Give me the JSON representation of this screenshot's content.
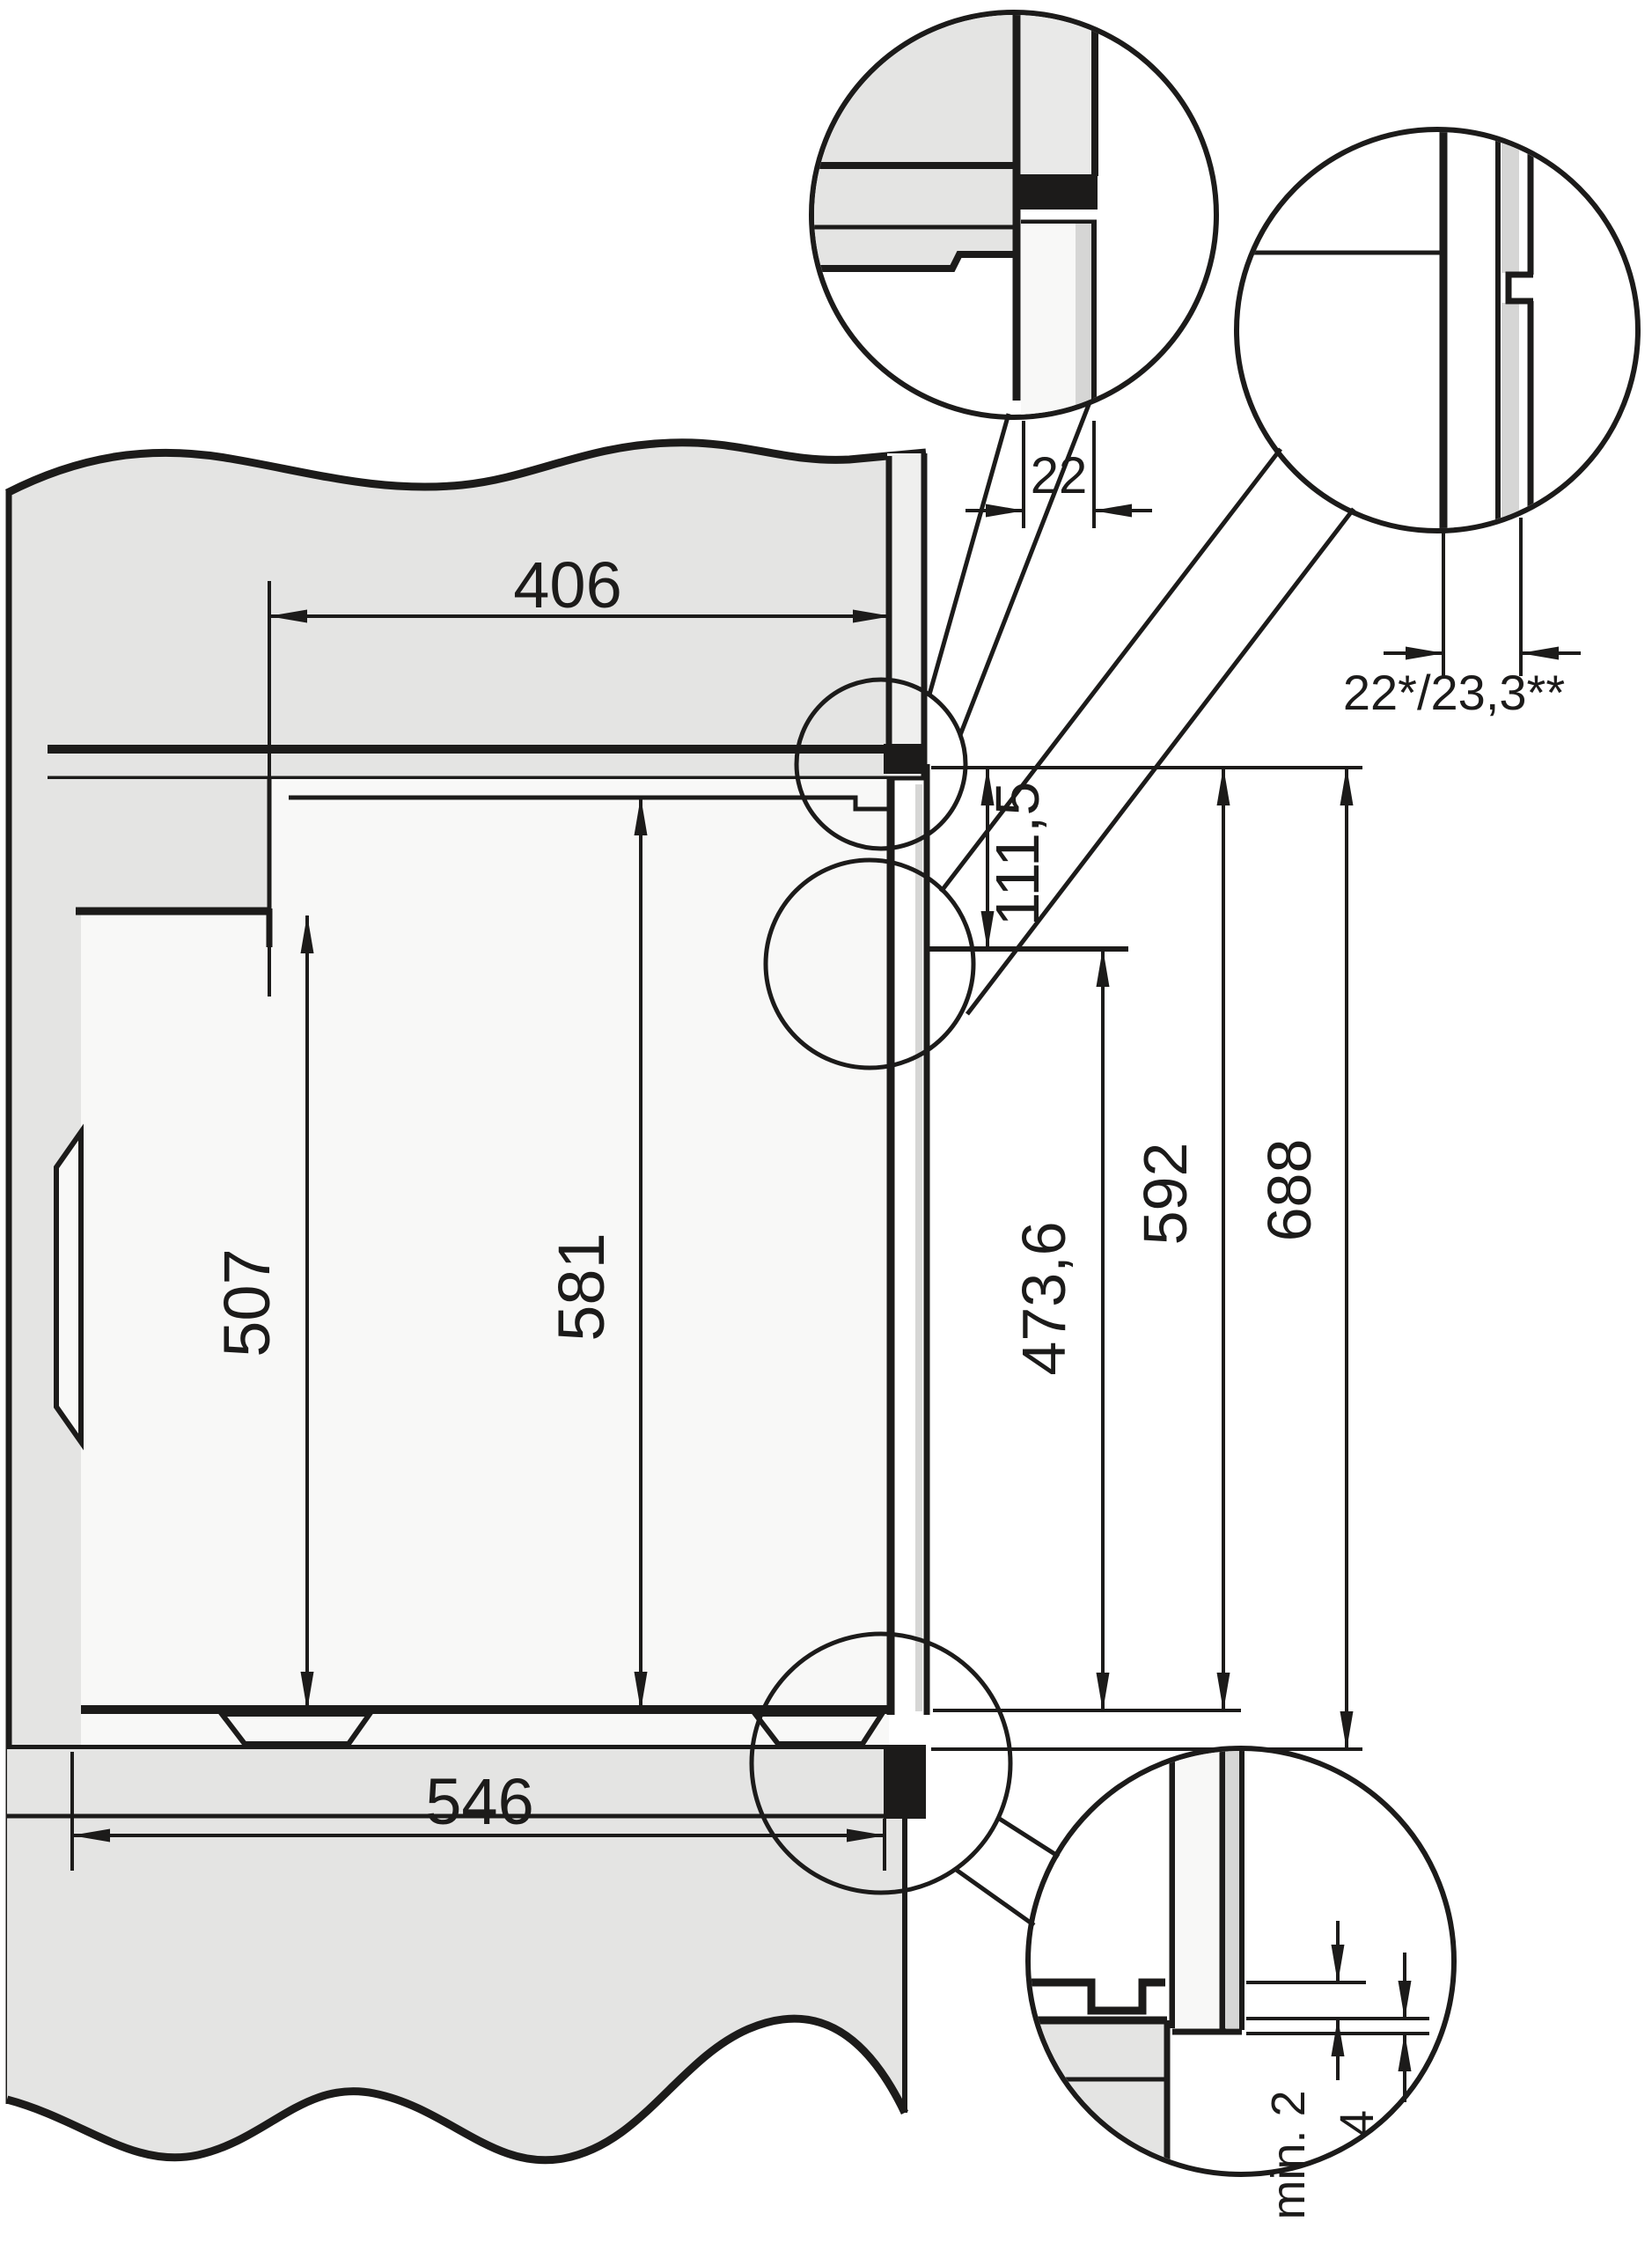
{
  "colors": {
    "ink": "#1c1b1a",
    "cabinet_fill": "#e4e4e3",
    "front_board_fill": "#efefee",
    "door_edge_fill": "#d6d6d5",
    "interior_fill": "#f8f8f7",
    "background": "#ffffff"
  },
  "dimensions": {
    "upper_niche_depth": "406",
    "lower_depth": "546",
    "rear_niche_height": "507",
    "front_niche_height": "581",
    "control_panel_height": "111,5",
    "door_front_height": "473,6",
    "front_total_height": "592",
    "niche_total_height": "688",
    "front_overhang": "22*/23,3**",
    "top_edge_clearance": "22",
    "bottom_min_clearance": "min. 2",
    "bottom_edge_overlap": "4"
  }
}
